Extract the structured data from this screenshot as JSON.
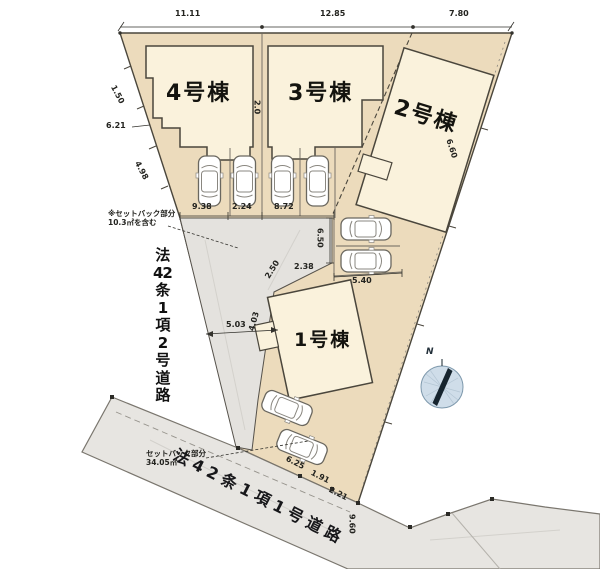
{
  "plan": {
    "buildings": [
      {
        "label": "1号棟"
      },
      {
        "label": "2号棟"
      },
      {
        "label": "3号棟"
      },
      {
        "label": "4号棟"
      }
    ],
    "roads": {
      "left_vertical": "法42条1項2号道路",
      "left_vertical_lines": [
        "法",
        "42",
        "条",
        "1",
        "項",
        "2",
        "号",
        "道",
        "路"
      ],
      "bottom_diagonal": "法42条1項1号道路"
    },
    "annotations": {
      "mid_left": {
        "line1": "※セットバック部分",
        "line2": "10.3㎡を含む"
      },
      "bottom_left": {
        "line1": "セットバック部分",
        "line2": "34.05㎡"
      },
      "compass_north": "N"
    },
    "dimensions": {
      "top": [
        "11.11",
        "12.85",
        "7.80"
      ],
      "parking_row": [
        "9.38",
        "2.24",
        "8.72"
      ],
      "road_width": "5.03",
      "v650": "6.50",
      "d238": "2.38",
      "d540": "5.40",
      "d621": "6.21",
      "d150": "1.50",
      "d498": "4.98",
      "d20": "2.0",
      "d660": "6.60",
      "d250": "2.50",
      "d403": "4.03",
      "d625": "6.25",
      "d191": "1.91",
      "d221": "2.21",
      "d960": "9.60"
    },
    "icons": {
      "car": "car-top-view-icon",
      "compass": "north-compass-icon"
    },
    "colors": {
      "plot_fill": "#ecdbbc",
      "building_fill": "#faf2dc",
      "road_fill": "#e5e3df",
      "outline": "#4a463c",
      "compass_fill": "#cfdde9"
    }
  }
}
